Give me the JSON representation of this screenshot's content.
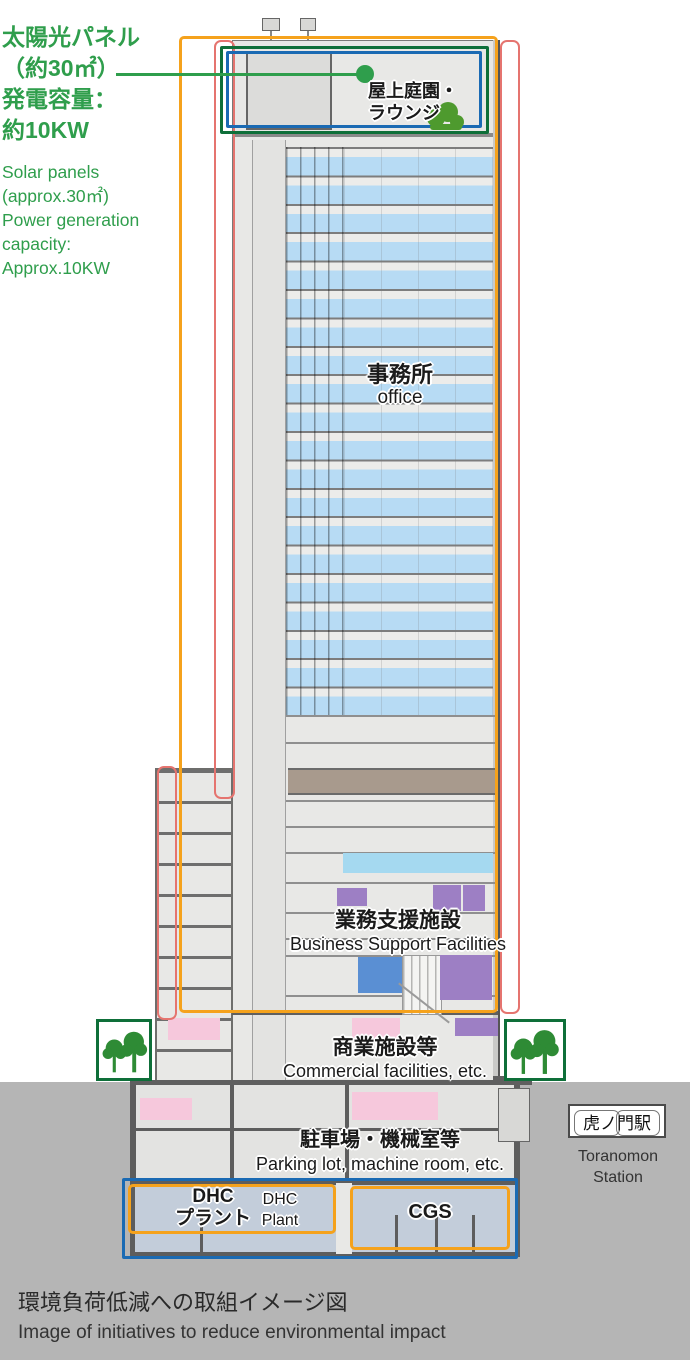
{
  "solar": {
    "jp": "太陽光パネル\n（約30㎡）\n発電容量：\n約10KW",
    "en": "Solar panels\n(approx.30㎡)\nPower generation\ncapacity:\nApprox.10KW"
  },
  "rooftop": {
    "jp": "屋上庭園・\nラウンジ"
  },
  "office": {
    "jp": "事務所",
    "en": "office"
  },
  "business": {
    "jp": "業務支援施設",
    "en": "Business Support Facilities"
  },
  "commercial": {
    "jp": "商業施設等",
    "en": "Commercial facilities, etc."
  },
  "parking": {
    "jp": "駐車場・機械室等",
    "en": "Parking lot, machine room, etc."
  },
  "dhc": {
    "jp": "DHC\nプラント",
    "en": "DHC\nPlant"
  },
  "cgs": {
    "label": "CGS"
  },
  "station": {
    "jp": "虎ノ門駅",
    "en": "Toranomon\nStation"
  },
  "caption": {
    "jp": "環境負荷低減への取組イメージ図",
    "en": "Image of initiatives to reduce environmental impact"
  },
  "icons": {
    "tree": "tree-icon",
    "leader_dot": "solar-leader-dot"
  },
  "colors": {
    "accent_green": "#2f9e4c",
    "frame_orange": "#f5a21c",
    "frame_pink": "#e5746f",
    "frame_green": "#0e6f39",
    "frame_blue": "#1a6ab3",
    "office_blue": "#b7dbf4",
    "light_blue_band": "#a5d9f0",
    "purple_block": "#9d7fc4",
    "blue_block": "#5a8fd3",
    "pink_block": "#f6c8dc",
    "brown_band": "#a89a8d",
    "plant_bluegray": "#c3cdda",
    "ground_gray": "#b5b5b5"
  }
}
